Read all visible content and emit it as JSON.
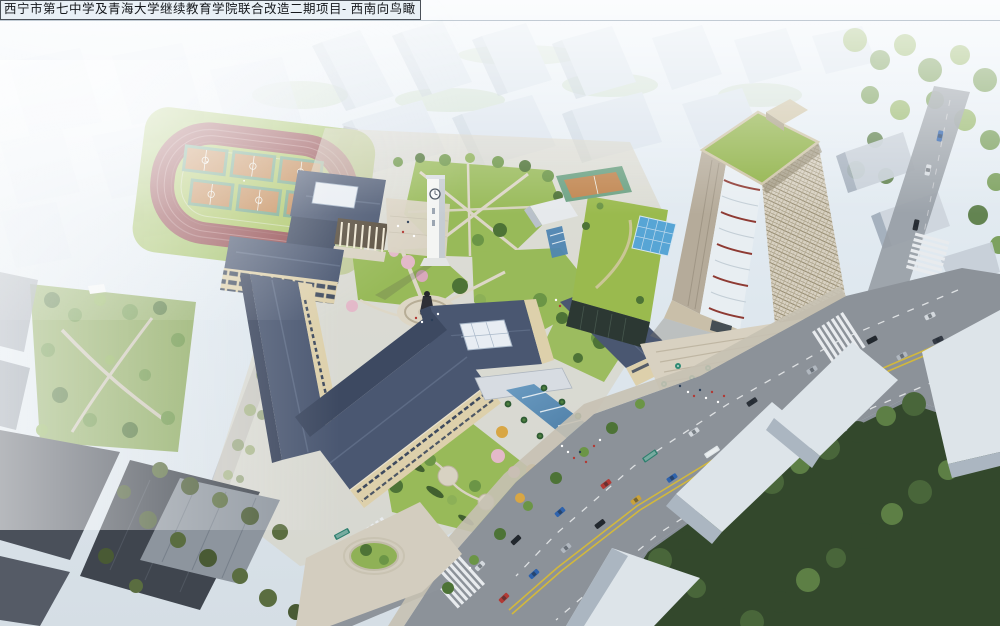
{
  "title_bar": {
    "text": "西宁市第七中学及青海大学继续教育学院联合改造二期项目- 西南向鸟瞰"
  },
  "scene": {
    "palette": {
      "sky": "#e8f0f6",
      "context_light": "#d9e3ec",
      "context_shadow": "#b7c4d1",
      "track": "#8f4549",
      "field": "#a8c360",
      "court": "#c0854f",
      "court_border": "#6ca183",
      "roof": "#4a5771",
      "roof_dark": "#3d4961",
      "wall": "#ddd0ab",
      "window": "#3e4a5e",
      "lawn": "#98ba59",
      "tree_light": "#8cb057",
      "tree_mid": "#6b9546",
      "tree_dark": "#4d7336",
      "forest": "#33482c",
      "forest2": "#49663a",
      "blossom": "#e3b9c9",
      "autumn": "#d8a644",
      "plaza": "#d9d3c3",
      "road": "#8c9299",
      "marking": "#eceef0",
      "lane_yellow": "#d2b83c",
      "water": "#4b80ab",
      "glass_white": "#e9eef2",
      "red_stripe": "#8e3a33",
      "tower_lattice": "#d8d1c2",
      "tower_left": "#b5ab9a",
      "tower_roof": "#8eb145",
      "podium_roof": "#9aba4e",
      "podium_glass": "#2c3833",
      "skylight_blue": "#57a5d5",
      "white_slab": "#dde4e9",
      "white_slab_face": "#abb6c1",
      "umbrella": "#2f8a74"
    }
  }
}
